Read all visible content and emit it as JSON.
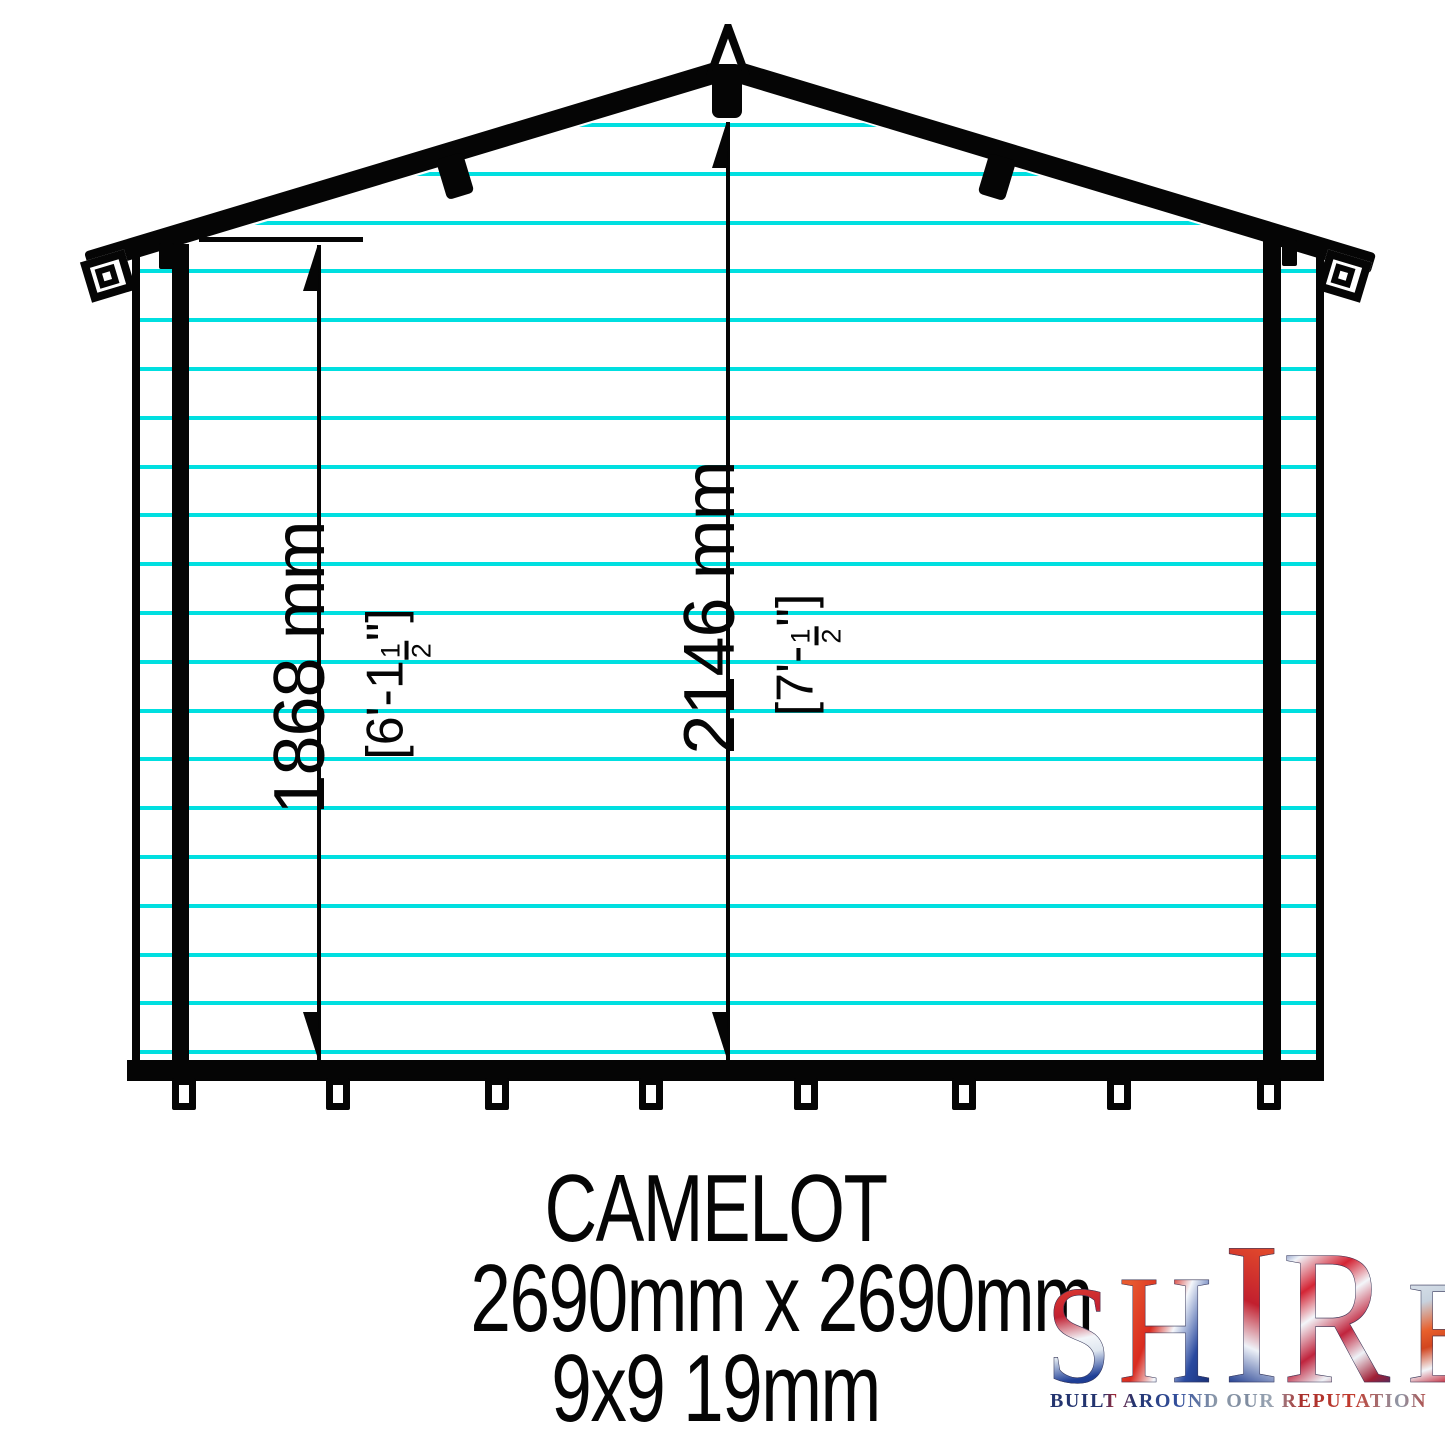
{
  "drawing": {
    "colors": {
      "outline": "#050505",
      "cladding_line": "#00dfe0"
    },
    "cladding": {
      "line_count": 20,
      "first_y": 123,
      "spacing": 48.8,
      "thickness": 4
    },
    "feet_centers": [
      184,
      338,
      497,
      651,
      806,
      964,
      1119,
      1269
    ],
    "dimensions": {
      "eaves": {
        "metric": "1868 mm",
        "imperial_prefix": "[6'-1",
        "frac_num": "1",
        "frac_den": "2",
        "imperial_suffix": "\"]"
      },
      "ridge": {
        "metric": "2146 mm",
        "imperial_prefix": "[7'-",
        "frac_num": "1",
        "frac_den": "2",
        "imperial_suffix": "\"]"
      }
    }
  },
  "caption": {
    "title": "CAMELOT",
    "footprint": "2690mm x 2690mm",
    "spec": "9x9 19mm"
  },
  "logo": {
    "name_letters": [
      "S",
      "H",
      "I",
      "R",
      "E"
    ],
    "tagline": "BUILT AROUND OUR REPUTATION",
    "colors": {
      "flag_red": "#c22032",
      "flag_blue": "#1f3f97",
      "flag_white": "#f3f6fa"
    }
  }
}
